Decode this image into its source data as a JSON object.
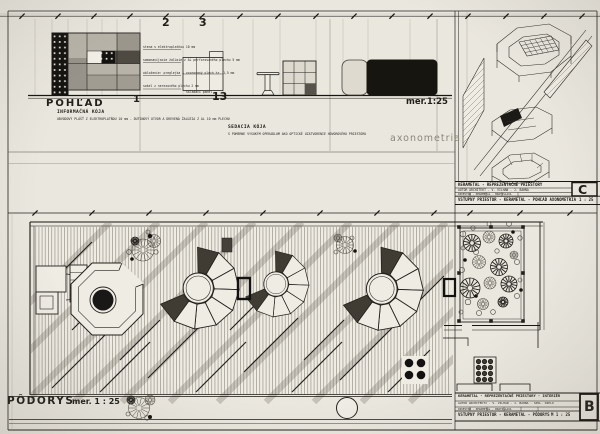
{
  "colors": {
    "paper": "#eae7df",
    "ink": "#201e19",
    "pencil": "#8b867a"
  },
  "top": {
    "title": "POHĽAD",
    "scale": "mer.1:25",
    "axonometria": "axonometria",
    "marks": {
      "m1": "1",
      "m2": "2",
      "m3": "3",
      "m13": "13"
    },
    "info_booth": {
      "name": "INFORMAČNÁ KÓJA",
      "note": "OBVODOVÝ PLÁŠŤ Z ELEKTROPLATŇOU 10 mm - DUTINOVÝ OTVOR A DREVENÁ ŽALÚZIA Z AL 10 mm PLECHU"
    },
    "seating_booth": {
      "name": "SEDACIA KÓJA",
      "note": "S POMERNE VYSOKÝM OPERADLOM AKO OPTICKÉ UZATVORENIE HOVOROVÉHO PRIESTORU"
    },
    "callouts": [
      "stena s elektroplatňou 10 mm",
      "samonavíjacie žalúzie z AL perforovaného plechu 5 mm",
      "obloženie: preglejka + vzorovaný plech hr. 1,5 mm",
      "sokel z nerezového plechu 2 mm"
    ],
    "detail_caption": "skladací panel"
  },
  "plan": {
    "title": "PÔDORYS",
    "scale": "mer. 1 : 25"
  },
  "titleblock_c": {
    "project": "KERAMETAL - REPREZENTAČNÉ PRIESTORY",
    "author": "AUTOR ARCHITEKT - V. VILHAN - J. BAHNA",
    "row3": "INVESTOR - KERAMETAL - BRATISLAVA",
    "content": "VSTUPNÝ PRIESTOR - KERAMETAL - POHĽAD AXONOMETRIA",
    "scale": "1 : 25",
    "sheet": "C"
  },
  "titleblock_b": {
    "project": "KERAMETAL - REPREZENTAČNÉ PRIESTORY - INTERIÉR",
    "author": "AUTOR ARCHITEKTI - V. VILHAN - J. BAHNA - SPOL. DIELO",
    "row3": "INVESTOR - KERAMETAL - BRATISLAVA",
    "content": "VSTUPNÝ PRIESTOR - KERAMETAL - PÔDORYS",
    "scale": "M 1 : 25",
    "sheet": "B"
  }
}
